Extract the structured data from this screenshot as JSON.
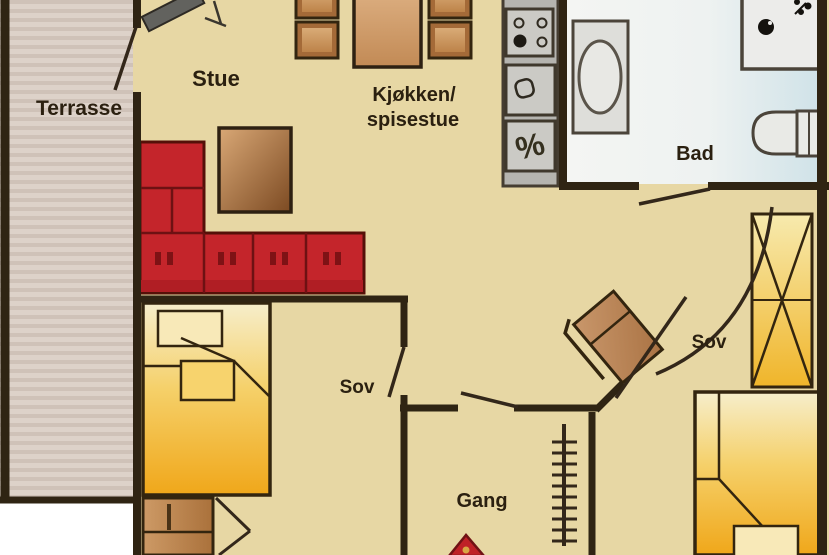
{
  "rooms": {
    "terrace": {
      "label": "Terrasse"
    },
    "living_room": {
      "label": "Stue"
    },
    "kitchen": {
      "label_line1": "Kjøkken/",
      "label_line2": "spisestue"
    },
    "bathroom": {
      "label": "Bad"
    },
    "bedroom_left": {
      "label": "Sov"
    },
    "bedroom_right": {
      "label": "Sov"
    },
    "hallway": {
      "label": "Gang"
    }
  },
  "symbols": {
    "dishwasher": "%"
  },
  "furniture": [
    "tv-bench",
    "corner-sofa",
    "coffee-table",
    "dining-table",
    "dining-chair",
    "kitchen-counter",
    "stove",
    "kitchen-sink",
    "dishwasher",
    "washbasin",
    "shower",
    "toilet",
    "double-bed",
    "pillow",
    "crib",
    "wardrobe",
    "armchair",
    "loft-ladder",
    "entrance-arrow"
  ],
  "colors": {
    "wall": "#2f2413",
    "floor": "#e7d7a4",
    "terrace_stripe_light": "#ddd2c9",
    "terrace_stripe_dark": "#cfc2b8",
    "sofa_red": "#c4252b",
    "wood_brown": "#b97f48",
    "bed_yellow": "#f0a71a",
    "bathroom_blue": "#cfe2e8",
    "counter_gray": "#b5b4af",
    "arrow_red": "#bf2127",
    "outside_white": "#ffffff",
    "label_text": "#2b2010"
  }
}
